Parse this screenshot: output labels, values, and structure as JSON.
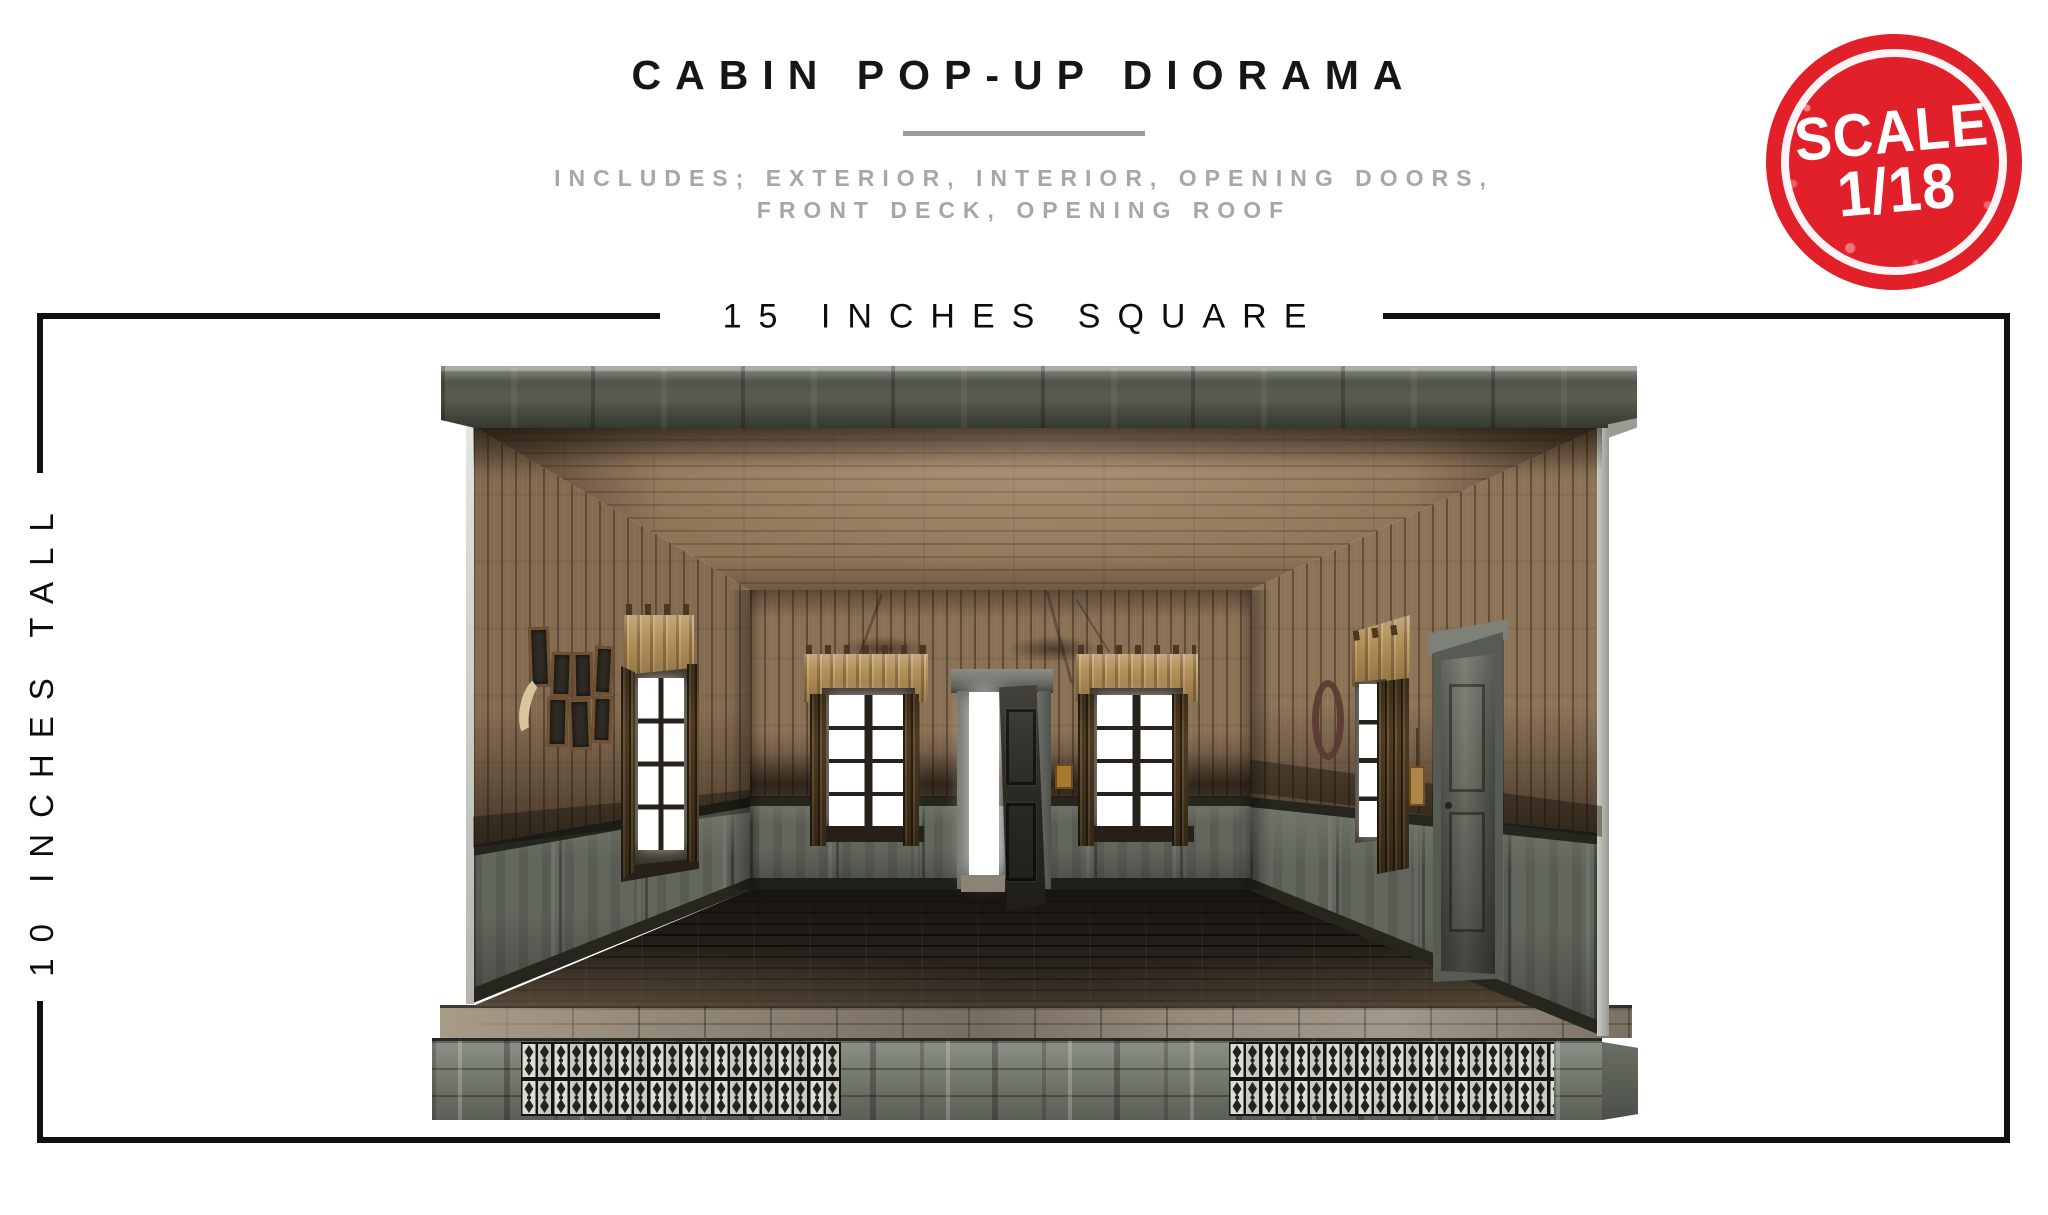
{
  "header": {
    "title": "CABIN POP-UP DIORAMA",
    "subtitle_line1": "INCLUDES; EXTERIOR, INTERIOR, OPENING DOORS,",
    "subtitle_line2": "FRONT DECK, OPENING ROOF"
  },
  "stamp": {
    "line1": "SCALE",
    "line2": "1/18",
    "background_color": "#e2202a",
    "text_color": "#ffffff"
  },
  "dimensions": {
    "width_label": "15 INCHES SQUARE",
    "height_label": "10 INCHES TALL",
    "line_color": "#111111"
  },
  "diorama": {
    "description": "Open-front rustic wooden cabin pop-up diorama interior with flat gray roof, plank walls, wainscoting, two curtained back windows, open center doorway, right-wall door, picture frames, antler mount, wreath, dark plank floor, front deck and pierced-vent base",
    "features": [
      "exterior",
      "interior",
      "opening doors",
      "front deck",
      "opening roof"
    ],
    "palette": {
      "roof_gray": "#51544c",
      "wall_wood": "#856c51",
      "ceiling_wood": "#8f7659",
      "wainscot_gray": "#62675e",
      "floor_dark": "#221d19",
      "deck_tan": "#95897a",
      "base_gray": "#7b8077",
      "valance_tan": "#b3915a",
      "curtain_brown": "#4e3b21",
      "window_white": "#ffffff",
      "doorway_white": "#ffffff",
      "wreath_maroon": "#5a3931"
    }
  }
}
